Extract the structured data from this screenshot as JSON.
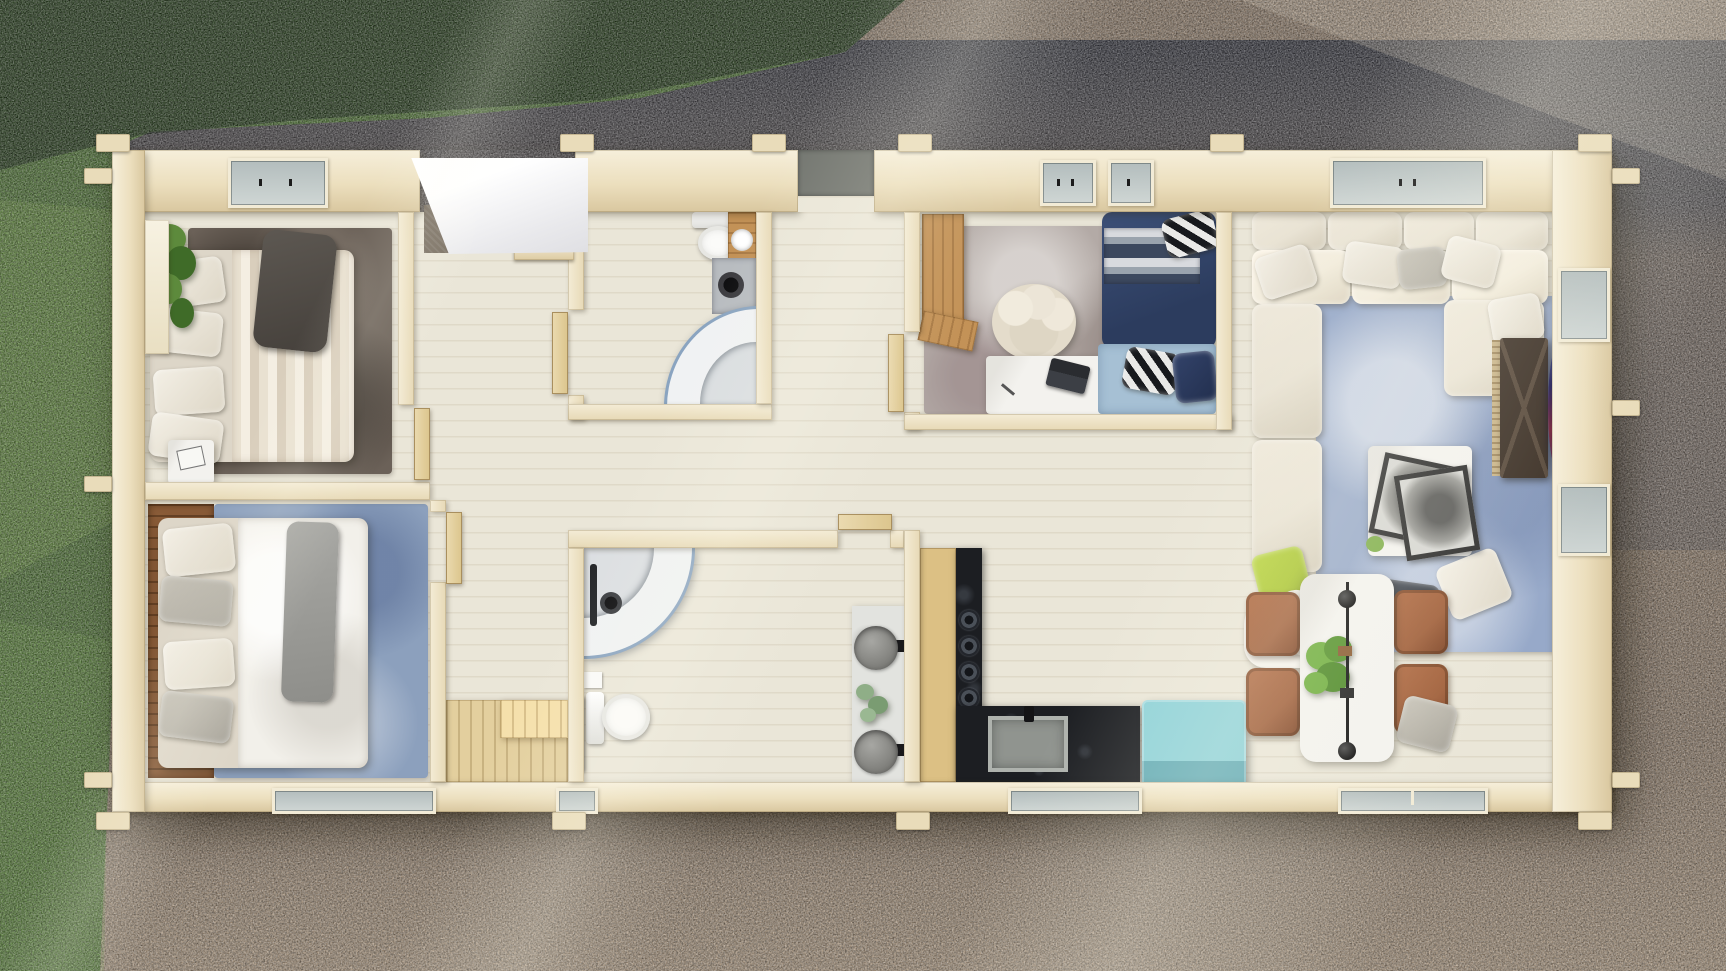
{
  "meta": {
    "title": "Aerial top-down 3D rendering of a single-storey log cabin floor plan",
    "view": "top-down aerial",
    "lighting": "bright sun from upper left, long diagonal light streaks and tree shadow across the top"
  },
  "environment": {
    "left_ground": "lawn grass strip",
    "top_ground": "shaded grass and dark gravel",
    "surrounding_ground": "brown gravel, sunlit at bottom right",
    "shadow_note": "top band of grass and gravel lies in deep shadow"
  },
  "palette": {
    "grass": "#4e7135",
    "grassDark": "#203618",
    "gravel": "#8e7c6a",
    "gravelShadow": "#3e414c",
    "gravelLight": "#a8967f",
    "wall": "#ecdfbe",
    "wallLight": "#f6efdb",
    "wallShade": "#d9c79f",
    "floor": "#eae6d8",
    "floorLine": "#d6cdb7",
    "rugDark": "#6b6158",
    "rugBlue": "#8ca0bd",
    "rugOffice": "#b3aaa6",
    "rugLiving": "#97a9c9",
    "rugBaby": "#a6c0d4",
    "navy": "#2c3c5e",
    "navyLight": "#3c5078",
    "sofa": "#e9e3d4",
    "woodDesk": "#c39257",
    "woodHead": "#8a5c38",
    "woodCab": "#dcc084",
    "woodStep": "#e3cf9e",
    "counter": "#1c1e22",
    "stone": "#8e8e8a",
    "mat": "#72756f",
    "teal": "#8fd2d8",
    "tealShade": "#66adb6",
    "chair": "#a05f3a",
    "table": "#f3f2ee",
    "white": "#f6f4ef",
    "greenPillow": "#a9c52f",
    "plant": "#5d8a3c",
    "plantDark": "#3f6b28",
    "glass": "#8aa4c0",
    "glassPane": "#b3bdbd",
    "canopy": "#fbfbfb",
    "doorWood": "#ead9ae",
    "radiator": "#3a3d40",
    "tvCab": "#3a2e24",
    "tvTile1": "#3f74e8",
    "tvTile2": "#2ab5a0",
    "tvTile3": "#36b24a",
    "tvTile4": "#18a0c8",
    "tvTile5": "#e23a2c",
    "tvTile6": "#f07c28",
    "tvTile7": "#8a35d8"
  },
  "house": {
    "style": "log cabin of pale whitewashed timber with crossed corner log ends",
    "label": "Log cabin floor plan",
    "entrance": {
      "label": "Main entrance with white canopy roof and two timber steps"
    },
    "back_door": {
      "label": "Rear doorway with grey step mat"
    },
    "rooms": {
      "bedroom1": {
        "label": "Bedroom 1 (top left)",
        "furniture": [
          "double bed with beige striped duvet",
          "charcoal throw draped over headboard",
          "stacked cream pillows",
          "white headboard shelf",
          "trailing green plant",
          "dark taupe rug",
          "white bedside cube with book"
        ]
      },
      "bedroom2": {
        "label": "Bedroom 2 (bottom left)",
        "furniture": [
          "double bed with white duvet",
          "grey throw",
          "timber plank headboard wall",
          "blue mottled rug",
          "cream and grey pillows"
        ]
      },
      "hallway": {
        "label": "Entrance hall with open interior doors",
        "furniture": [
          "open timber doors",
          "raised timber platform step"
        ]
      },
      "bathroom1": {
        "label": "Shower room (top)",
        "furniture": [
          "toilet",
          "timber washstand with round basin",
          "corner quarter-round glass shower",
          "grey shower mat with rain head"
        ]
      },
      "bathroom2": {
        "label": "Bathroom (bottom)",
        "furniture": [
          "corner quarter-round glass shower with black fixture",
          "toilet",
          "dark towel radiator",
          "double stone-basin vanity",
          "eucalyptus sprig"
        ]
      },
      "office": {
        "label": "Study / guest bedroom",
        "furniture": [
          "timber wardrobe desk",
          "grey mottled rug",
          "cream tub chair",
          "white desk with black laptop",
          "single bed with navy and grey striped bedding",
          "black-and-white striped pillows",
          "light blue foot rug"
        ]
      },
      "living": {
        "label": "Living room",
        "furniture": [
          "L-shaped cream sectional sofa",
          "white and grey scatter cushions",
          "lime green cushion",
          "white throw blanket",
          "blue mottled rug",
          "white coffee table with two framed monochrome artworks",
          "charcoal floor cushions",
          "dark TV sideboard with curved smart TV showing coloured app tiles"
        ]
      },
      "kitchen": {
        "label": "Kitchen",
        "furniture": [
          "tall timber cabinet",
          "L-shaped black granite counter",
          "four-burner gas hob",
          "square stone sink with black tap",
          "turquoise storage chest"
        ]
      },
      "dining": {
        "label": "Dining area",
        "furniture": [
          "white dining table",
          "black linear pendant light",
          "green table plant",
          "four terracotta armchairs",
          "grey cloth over chair"
        ]
      }
    },
    "windows": {
      "top_wall": 3,
      "bottom_wall": 4,
      "right_wall": 2
    }
  }
}
